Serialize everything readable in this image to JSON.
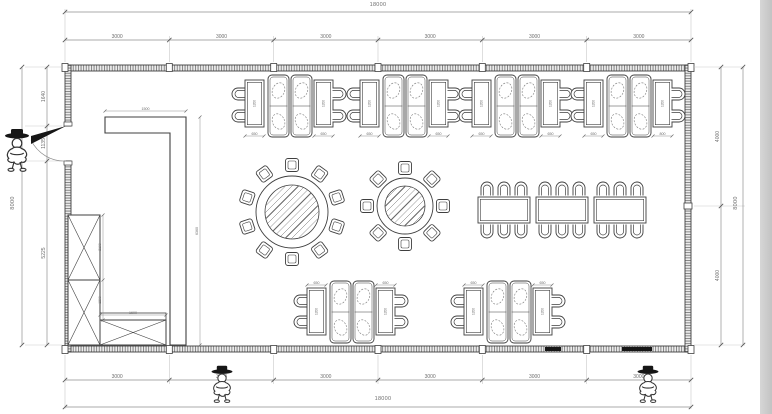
{
  "palette": {
    "line": "#3f3f3f",
    "dim_line": "#8f8f8f",
    "dim_text": "#6e6e6e",
    "ext_line": "#c9c9c9",
    "hatch": "#7d7d7d",
    "wall_fill": "#ececec",
    "dark_fill": "#161616",
    "paper": "#ffffff",
    "scan_strip": "#c9c9c9"
  },
  "dimensions": {
    "top_overall": "18000",
    "bottom_overall": "18000",
    "top_segments": [
      "3000",
      "3000",
      "3000",
      "3000",
      "3000",
      "3000"
    ],
    "bottom_segments": [
      "3000",
      "3000",
      "3000",
      "3000",
      "3000",
      "3000"
    ],
    "left_overall": "8000",
    "left_segments": [
      "1640",
      "1135",
      "5225"
    ],
    "right_overall": "8000",
    "right_segments": [
      "4000",
      "4000"
    ],
    "counter_width": "1500",
    "counter_height": "6360",
    "cabinet_upper": "2100",
    "cabinet_lower": "1200",
    "cabinet_bottom_width": "1600",
    "booth_table_length": "1200"
  },
  "floorplan": {
    "wall": {
      "x1": 65,
      "y1": 65,
      "x2": 691,
      "y2": 352,
      "t": 6
    },
    "grid_x": [
      65,
      169.3,
      273.7,
      378,
      482.3,
      586.7,
      691
    ],
    "door": {
      "y1": 126,
      "y2": 161
    },
    "right_wall_tick_y": 206,
    "top_booth_groups": [
      {
        "x": 233,
        "labels": [
          "650",
          "650"
        ]
      },
      {
        "x": 348,
        "labels": [
          "650",
          "650"
        ]
      },
      {
        "x": 460,
        "labels": [
          "650",
          "650"
        ]
      },
      {
        "x": 572,
        "labels": [
          "650",
          "800"
        ]
      }
    ],
    "bottom_booth_groups": [
      {
        "x": 295,
        "labels": [
          "650",
          "650"
        ]
      },
      {
        "x": 452,
        "labels": [
          "650",
          "650"
        ]
      }
    ],
    "round_tables": [
      {
        "cx": 292,
        "cy": 212,
        "r_table": 36,
        "r_top": 27,
        "chairs": 10,
        "chair_r": 47
      },
      {
        "cx": 405,
        "cy": 206,
        "r_table": 28,
        "r_top": 20,
        "chairs": 8,
        "chair_r": 38
      }
    ],
    "banquet": {
      "x": 478,
      "y": 197,
      "tw": 52,
      "th": 26,
      "gap": 6,
      "count": 3,
      "per_side": 3
    },
    "counter": {
      "pts": [
        [
          105,
          117
        ],
        [
          186,
          117
        ],
        [
          186,
          345
        ],
        [
          170,
          345
        ],
        [
          170,
          133
        ],
        [
          105,
          133
        ]
      ]
    },
    "cabinets": [
      {
        "x": 68,
        "y": 215,
        "w": 32,
        "h": 65
      },
      {
        "x": 68,
        "y": 280,
        "w": 32,
        "h": 65
      },
      {
        "x": 100,
        "y": 320,
        "w": 66,
        "h": 25,
        "header": true
      }
    ],
    "wall_solid_segments": [
      [
        545,
        16
      ],
      [
        622,
        30
      ]
    ],
    "persons": [
      {
        "cx": 17,
        "cy": 150,
        "s": 1.5
      },
      {
        "cx": 222,
        "cy": 384,
        "s": 1.3
      },
      {
        "cx": 648,
        "cy": 384,
        "s": 1.3
      }
    ]
  }
}
